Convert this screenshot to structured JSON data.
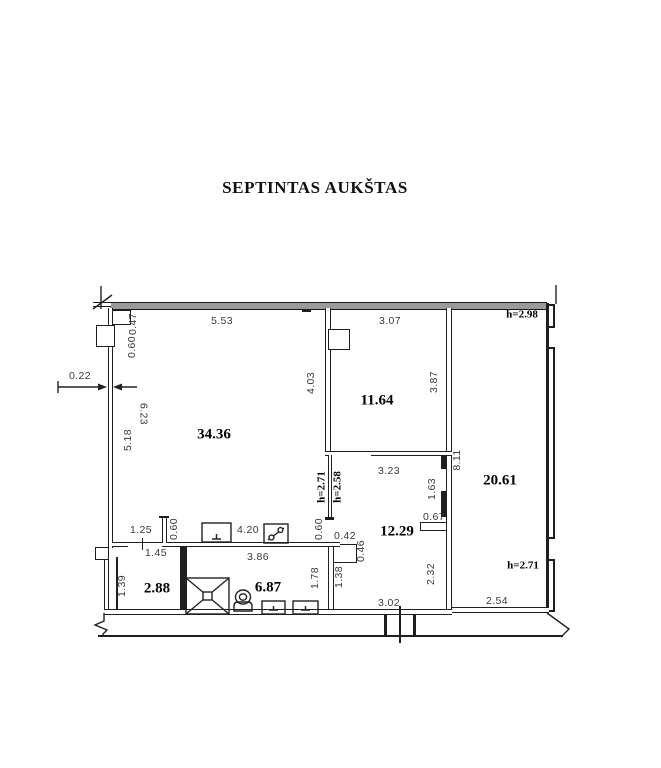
{
  "title": "SEPTINTAS AUKŠTAS",
  "rooms": {
    "living_area": "34.36",
    "bedroom_area": "11.64",
    "right_room_area": "20.61",
    "hall_area": "12.29",
    "closet_area": "2.88",
    "bathroom_area": "6.87"
  },
  "heights": {
    "top_right": "h=2.98",
    "bottom_right": "h=2.71",
    "door_left": "h=2.71",
    "door_right": "h=2.58"
  },
  "dims": {
    "wall_thickness": "0.22",
    "top_width_left": "5.53",
    "top_width_right": "3.07",
    "pilaster_depth": "0.47",
    "pilaster_width": "0.60",
    "living_left_a": "5.18",
    "living_left_b": "6.23",
    "bedroom_left": "4.03",
    "bedroom_right": "3.87",
    "hall_top": "3.23",
    "right_room_side": "8.11",
    "hall_door_side": "1.63",
    "wall_stub_right": "0.67",
    "kitchen_offset": "1.25",
    "kitchen_stub": "0.60",
    "kitchen_run": "4.20",
    "partition_stub": "0.60",
    "niche_width": "0.42",
    "niche_depth": "0.46",
    "closet_door": "1.45",
    "bathroom_width": "3.86",
    "bathroom_right": "1.78",
    "hall_wall": "1.38",
    "hall_side": "2.32",
    "closet_side": "1.39",
    "hall_bottom": "3.02",
    "right_room_bottom": "2.54"
  }
}
